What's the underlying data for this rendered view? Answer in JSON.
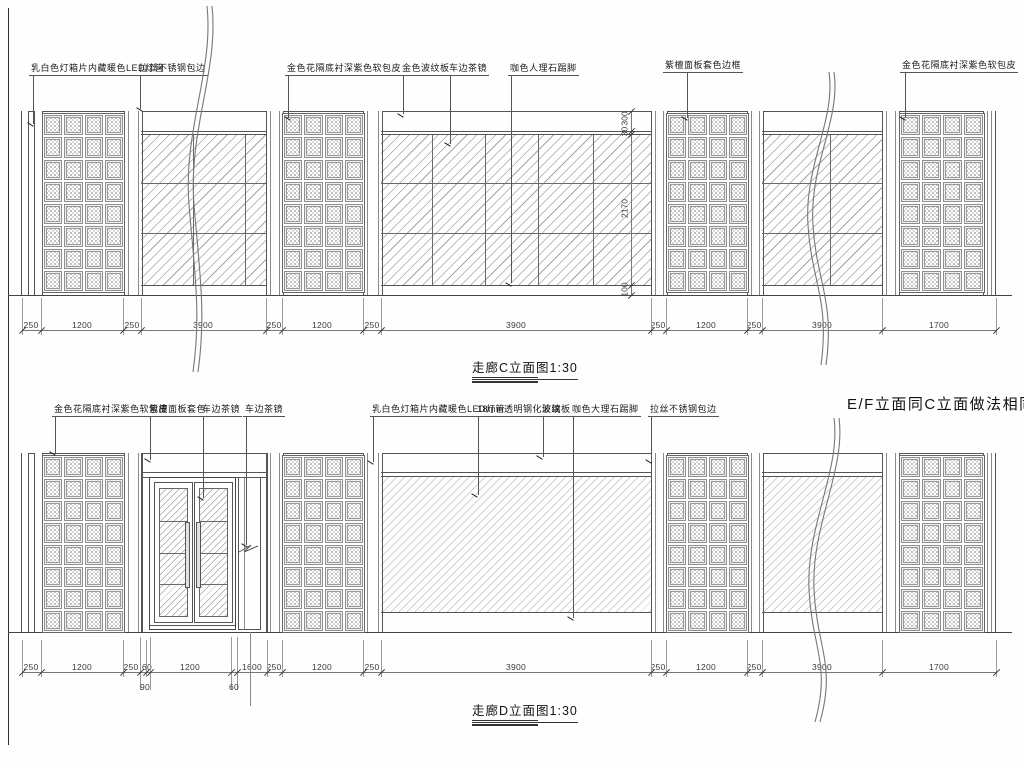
{
  "note_ef": "E/F立面同C立面做法相同",
  "elev_c": {
    "title": "走廊C立面图1:30",
    "labels": [
      "乳白色灯箱片内藏暖色LED灯管",
      "拉丝不锈钢包边",
      "金色花隔底衬深紫色软包皮",
      "金色波纹板",
      "车边茶镜",
      "咖色人理石踢脚",
      "紫檀面板套色边框",
      "金色花隔底衬深紫色软包皮"
    ],
    "dims": [
      "250",
      "1200",
      "250",
      "3900",
      "250",
      "1200",
      "250",
      "3900",
      "250",
      "1200",
      "250",
      "3900",
      "1700"
    ],
    "vdims": [
      "300",
      "30",
      "2170",
      "100"
    ]
  },
  "elev_d": {
    "title": "走廊D立面图1:30",
    "labels": [
      "金色花隔底衬深紫色软包皮",
      "紫檀面板套色",
      "车边茶镜",
      "车边茶镜",
      "乳白色灯箱片内藏暖色LED灯管",
      "18mm透明钢化玻璃",
      "波纹板",
      "咖色大理石踢脚",
      "拉丝不锈钢包边"
    ],
    "dims": [
      "250",
      "1200",
      "250",
      "60",
      "1200",
      "1600",
      "250",
      "1200",
      "250",
      "3900",
      "250",
      "1200",
      "250",
      "3900",
      "1700"
    ],
    "subdims": [
      "90",
      "60"
    ]
  }
}
